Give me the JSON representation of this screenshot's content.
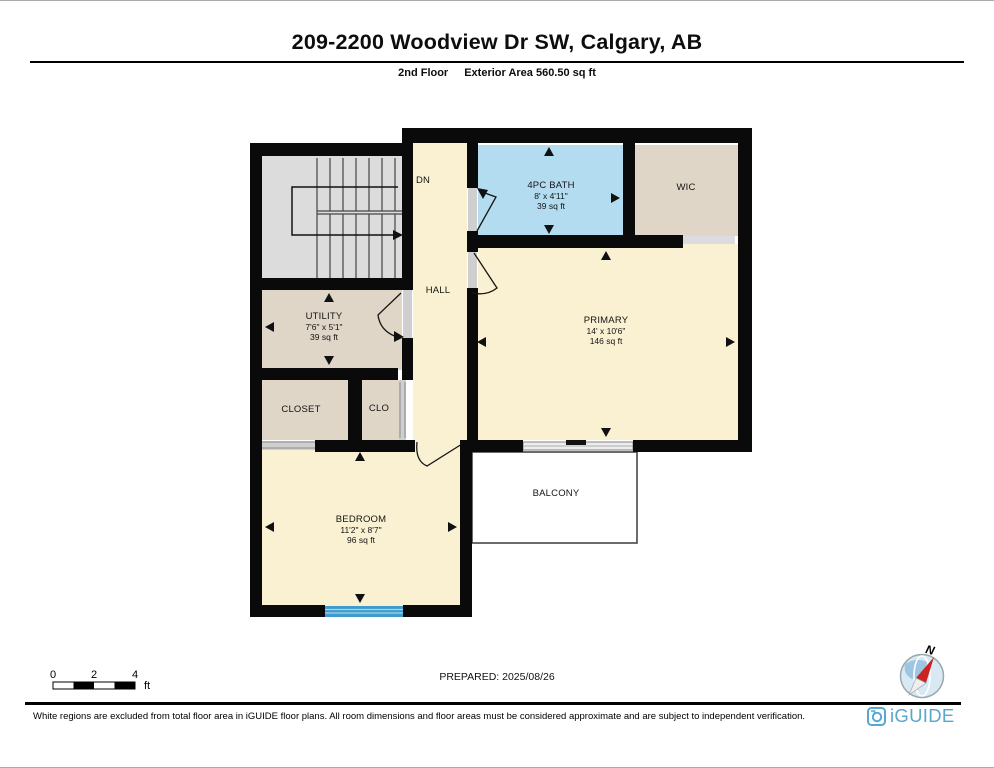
{
  "header": {
    "title": "209-2200 Woodview Dr SW, Calgary, AB",
    "floor_label": "2nd Floor",
    "area_label": "Exterior Area 560.50 sq ft"
  },
  "rooms": {
    "dn_label": "DN",
    "hall": "HALL",
    "balcony": "BALCONY",
    "bath": {
      "name": "4PC BATH",
      "dims": "8' x 4'11\"",
      "area": "39 sq ft"
    },
    "wic": {
      "name": "WIC"
    },
    "primary": {
      "name": "PRIMARY",
      "dims": "14' x 10'6\"",
      "area": "146 sq ft"
    },
    "utility": {
      "name": "UTILITY",
      "dims": "7'6\" x 5'1\"",
      "area": "39 sq ft"
    },
    "closet": {
      "name": "CLOSET"
    },
    "clo": {
      "name": "CLO"
    },
    "bedroom": {
      "name": "BEDROOM",
      "dims": "11'2\" x 8'7\"",
      "area": "96 sq ft"
    }
  },
  "scale_bar": {
    "tick0": "0",
    "tick2": "2",
    "tick4": "4",
    "unit": "ft"
  },
  "compass": {
    "north": "N"
  },
  "footer": {
    "prepared": "PREPARED: 2025/08/26",
    "disclaimer": "White regions are excluded from total floor area in iGUIDE floor plans. All room dimensions and floor areas must be considered approximate and are subject to independent verification.",
    "logo": "iGUIDE"
  },
  "colors": {
    "wall": "#0a0a0a",
    "cream": "#FAF0D2",
    "tan": "#DFD6C7",
    "bath_blue": "#B3DCF1",
    "stairs_gray": "#DCDCDC",
    "window_blue": "#3D9BCE",
    "logo_blue": "#57A8CE",
    "compass_red": "#CC2222"
  }
}
